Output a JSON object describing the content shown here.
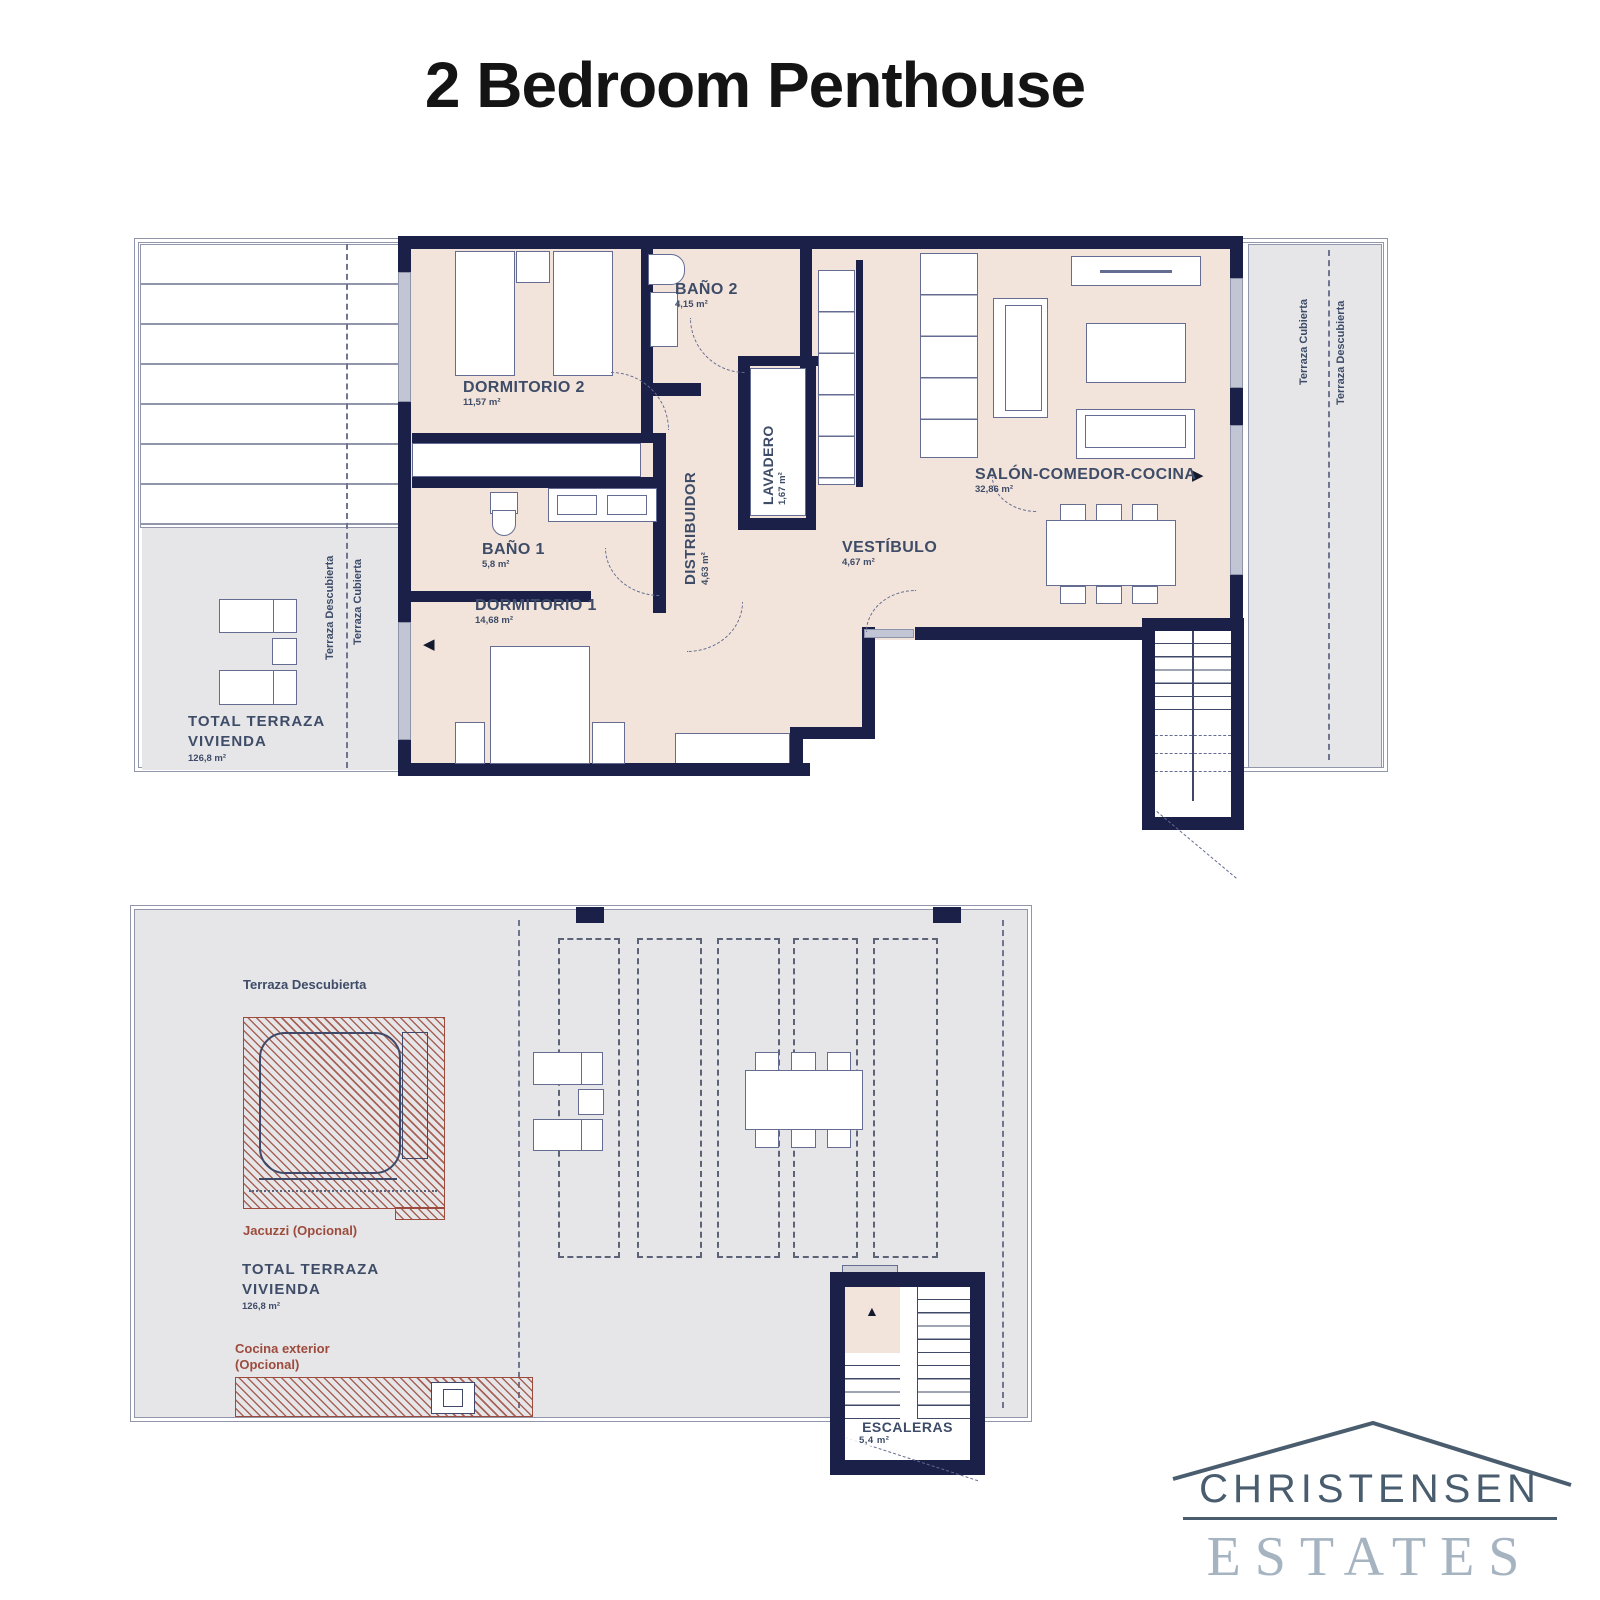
{
  "title": "2 Bedroom Penthouse",
  "colors": {
    "wall": "#1a2048",
    "floor": "#f2e4da",
    "terrace": "#e6e6e8",
    "hatch_red": "#9c4b3c",
    "label": "#3e4c68",
    "logo_dark": "#4a5d6e",
    "logo_light": "#a6b4c1"
  },
  "icons": {
    "arrow_left": "◀",
    "arrow_right": "▶",
    "arrow_up": "▲"
  },
  "upper": {
    "rooms": {
      "dormitorio2": {
        "name": "DORMITORIO 2",
        "area": "11,57 m²"
      },
      "bano2": {
        "name": "BAÑO 2",
        "area": "4,15 m²"
      },
      "lavadero": {
        "name": "LAVADERO",
        "area": "1,67 m²"
      },
      "distribuidor": {
        "name": "DISTRIBUIDOR",
        "area": "4,63 m²"
      },
      "salon": {
        "name": "SALÓN-COMEDOR-COCINA",
        "area": "32,86 m²"
      },
      "vestibulo": {
        "name": "VESTÍBULO",
        "area": "4,67 m²"
      },
      "bano1": {
        "name": "BAÑO 1",
        "area": "5,8 m²"
      },
      "dormitorio1": {
        "name": "DORMITORIO 1",
        "area": "14,68 m²"
      }
    },
    "terrace": {
      "left_descubierta": "Terraza Descubierta",
      "left_cubierta": "Terraza Cubierta",
      "right_cubierta": "Terraza Cubierta",
      "right_descubierta": "Terraza Descubierta",
      "total_line1": "TOTAL  TERRAZA",
      "total_line2": "VIVIENDA",
      "total_area": "126,8 m²"
    }
  },
  "lower": {
    "terraza_descubierta": "Terraza Descubierta",
    "jacuzzi": "Jacuzzi (Opcional)",
    "total_line1": "TOTAL  TERRAZA",
    "total_line2": "VIVIENDA",
    "total_area": "126,8 m²",
    "cocina_line1": "Cocina exterior",
    "cocina_line2": "(Opcional)",
    "escaleras": {
      "name": "ESCALERAS",
      "area": "5,4 m²"
    }
  },
  "logo": {
    "name": "CHRISTENSEN",
    "type": "ESTATES"
  }
}
